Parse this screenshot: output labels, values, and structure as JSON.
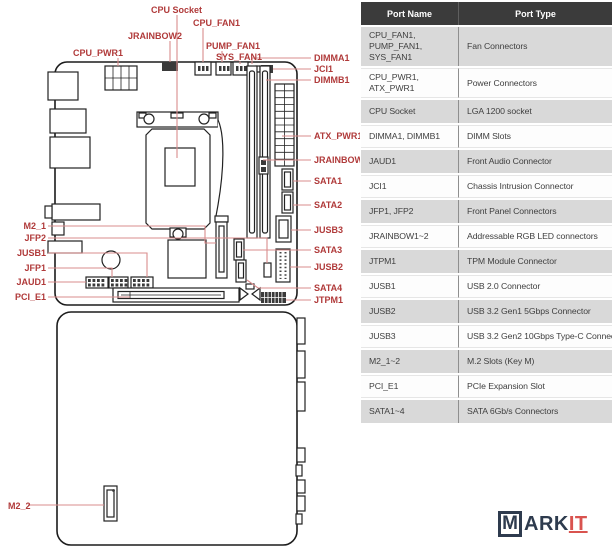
{
  "colors": {
    "label_red": "#b03a3a",
    "leader_line": "#d98c8c",
    "table_header_bg": "#3b3b3b",
    "table_header_text": "#ffffff",
    "table_row_gray": "#d9d9d9",
    "logo_navy": "#2e3b4e",
    "logo_red": "#d9534f"
  },
  "diagram": {
    "labels": {
      "cpu_socket": "CPU Socket",
      "cpu_fan1": "CPU_FAN1",
      "jrainbow2": "JRAINBOW2",
      "pump_fan1": "PUMP_FAN1",
      "cpu_pwr1": "CPU_PWR1",
      "sys_fan1": "SYS_FAN1",
      "dimma1": "DIMMA1",
      "jci1": "JCI1",
      "dimmb1": "DIMMB1",
      "atx_pwr1": "ATX_PWR1",
      "jrainbow1": "JRAINBOW1",
      "sata1": "SATA1",
      "sata2": "SATA2",
      "jusb3": "JUSB3",
      "sata3": "SATA3",
      "jusb2": "JUSB2",
      "sata4": "SATA4",
      "jtpm1": "JTPM1",
      "m2_1": "M2_1",
      "jfp2": "JFP2",
      "jusb1": "JUSB1",
      "jfp1": "JFP1",
      "jaud1": "JAUD1",
      "pci_e1": "PCI_E1",
      "m2_2": "M2_2"
    }
  },
  "table": {
    "headers": {
      "name": "Port Name",
      "type": "Port Type"
    },
    "rows": [
      {
        "name": "CPU_FAN1, PUMP_FAN1, SYS_FAN1",
        "type": "Fan Connectors"
      },
      {
        "name": "CPU_PWR1, ATX_PWR1",
        "type": "Power Connectors"
      },
      {
        "name": "CPU Socket",
        "type": "LGA 1200 socket"
      },
      {
        "name": "DIMMA1, DIMMB1",
        "type": "DIMM Slots"
      },
      {
        "name": "JAUD1",
        "type": "Front Audio Connector"
      },
      {
        "name": "JCI1",
        "type": "Chassis Intrusion Connector"
      },
      {
        "name": "JFP1, JFP2",
        "type": "Front Panel Connectors"
      },
      {
        "name": "JRAINBOW1~2",
        "type": "Addressable RGB LED connectors"
      },
      {
        "name": "JTPM1",
        "type": "TPM Module Connector"
      },
      {
        "name": "JUSB1",
        "type": "USB 2.0 Connector"
      },
      {
        "name": "JUSB2",
        "type": "USB 3.2 Gen1 5Gbps Connector"
      },
      {
        "name": "JUSB3",
        "type": "USB 3.2 Gen2 10Gbps Type-C Connector"
      },
      {
        "name": "M2_1~2",
        "type": "M.2 Slots (Key M)"
      },
      {
        "name": "PCI_E1",
        "type": "PCIe Expansion Slot"
      },
      {
        "name": "SATA1~4",
        "type": "SATA 6Gb/s Connectors"
      }
    ]
  },
  "logo": {
    "m": "M",
    "ark": "ARK",
    "it": "IT"
  }
}
